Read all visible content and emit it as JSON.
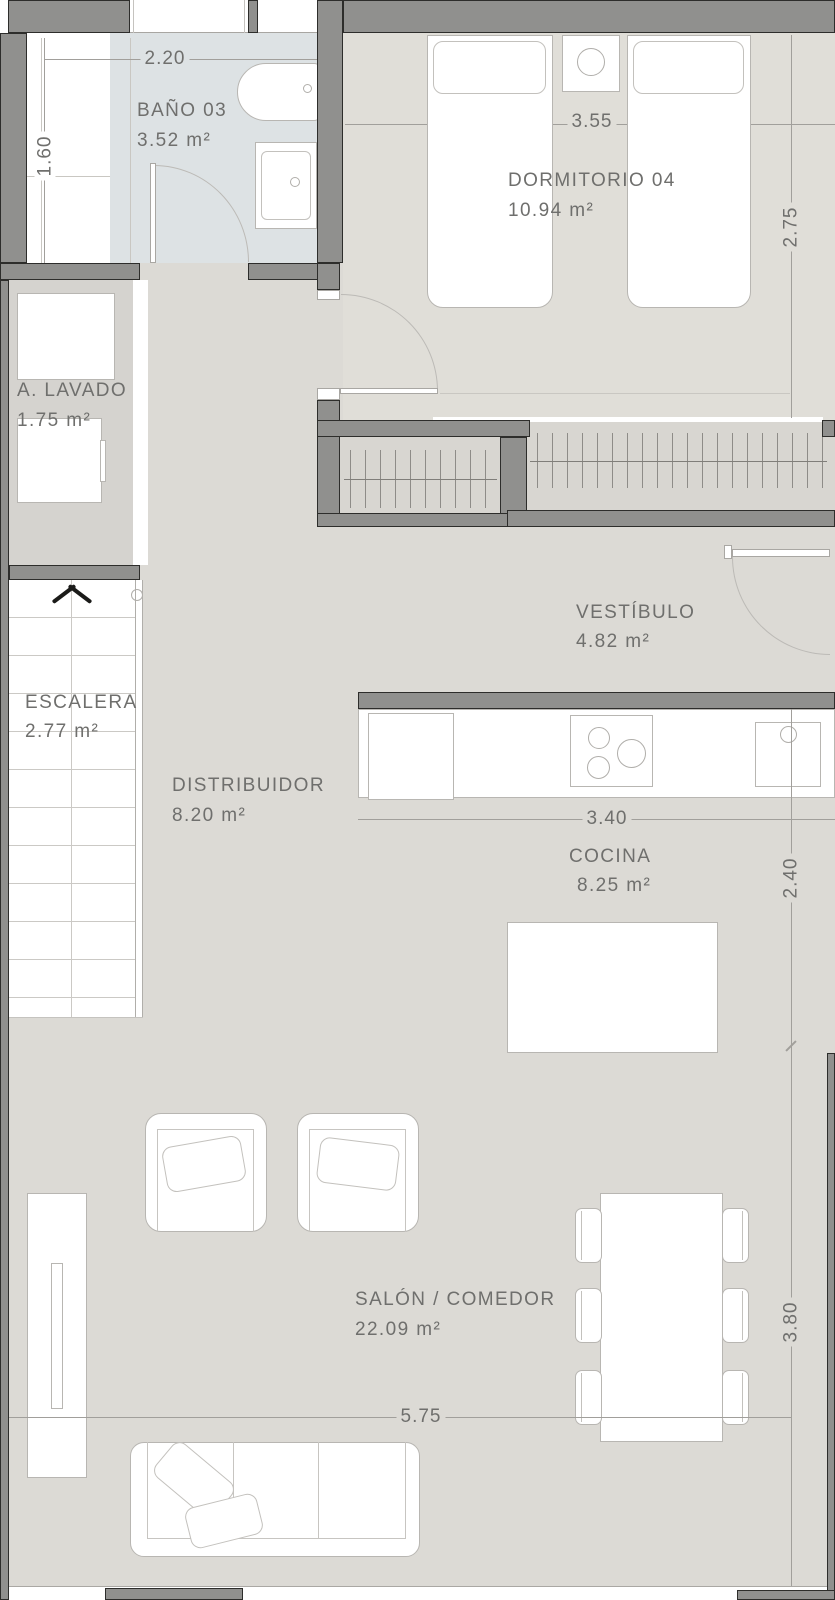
{
  "plan": {
    "title": "apartment-floor-plan",
    "rooms": [
      {
        "name": "BAÑO 03",
        "area": "3.52 m²"
      },
      {
        "name": "DORMITORIO 04",
        "area": "10.94 m²"
      },
      {
        "name": "A. LAVADO",
        "area": "1.75 m²"
      },
      {
        "name": "VESTÍBULO",
        "area": "4.82 m²"
      },
      {
        "name": "ESCALERA",
        "area": "2.77 m²"
      },
      {
        "name": "DISTRIBUIDOR",
        "area": "8.20 m²"
      },
      {
        "name": "COCINA",
        "area": "8.25 m²"
      },
      {
        "name": "SALÓN / COMEDOR",
        "area": "22.09 m²"
      }
    ],
    "dimensions": {
      "bano_width": "2.20",
      "bano_depth": "1.60",
      "dormitorio_width": "3.55",
      "dormitorio_depth": "2.75",
      "cocina_width": "3.40",
      "cocina_depth": "2.40",
      "salon_width": "5.75",
      "salon_depth": "3.80"
    },
    "colors": {
      "wall": "#90908e",
      "wall_outline": "#2d2d2b",
      "floor_main": "#dcdad5",
      "floor_dormitorio": "#e0ded8",
      "floor_bathroom": "#dde2e4",
      "floor_laundry": "#d5d3cf",
      "floor_wardrobe": "#d8d6d1",
      "furniture_outline": "#b8b6b2",
      "text": "#6f6f6d",
      "dimension_line": "#a19f9b"
    }
  }
}
